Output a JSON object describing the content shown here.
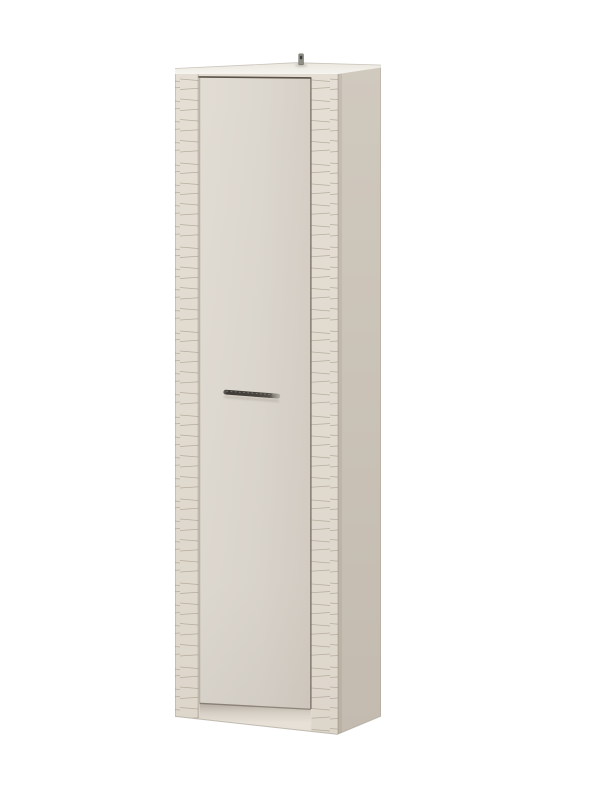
{
  "meta": {
    "subject": "Tall narrow single-door wardrobe cabinet in beige cashmere finish with wave-textured pilasters, product photo on white background"
  },
  "canvas": {
    "width": 601,
    "height": 800,
    "background": "#ffffff"
  },
  "cabinet": {
    "parts": {
      "top_panel": "top panel",
      "hanging_bracket": "wall hanging bracket",
      "left_pilaster": "left wave-textured pilaster",
      "right_pilaster": "right wave-textured pilaster",
      "door": "hinged door",
      "door_handle": "metal bar handle",
      "side_panel": "right side panel",
      "plinth": "recessed plinth"
    },
    "colors": {
      "front_frame": "#e2dcd2",
      "pilaster_top": "#e4ded4",
      "pilaster_bottom": "#ddd6cb",
      "groove_line": "#a89d8b",
      "door_left": "#e1dcd4",
      "door_mid": "#dcd7cf",
      "door_right": "#d5cfc6",
      "side_top": "#d0c9be",
      "side_bottom": "#c3bbaf",
      "top_back": "#e9e6df",
      "top_front": "#f6f4ee",
      "plinth_face": "#e6e0d6",
      "gap_line": "#5a5248",
      "handle_mid": "#6a665e",
      "handle_dark": "#3e3a35",
      "handle_tip": "#b5b1a9",
      "bracket_metal": "#8e8d86",
      "bracket_hole": "#3f3e3a"
    }
  }
}
